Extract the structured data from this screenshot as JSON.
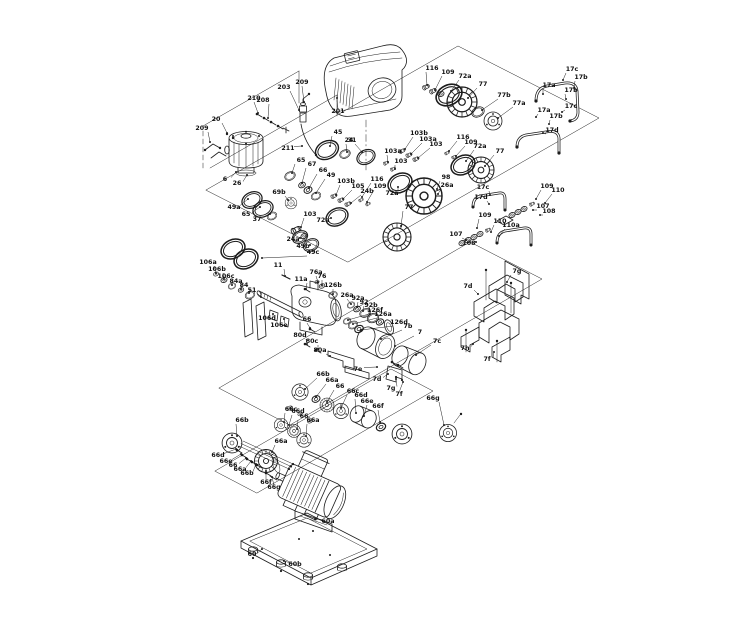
{
  "colors": {
    "background": "#ffffff",
    "line": "#1c1c1c",
    "label": "#111111"
  },
  "labels": [
    {
      "t": "208",
      "x": 263,
      "y": 102,
      "ex": 268,
      "ey": 118
    },
    {
      "t": "203",
      "x": 284,
      "y": 89,
      "ex": 299,
      "ey": 110
    },
    {
      "t": "209",
      "x": 302,
      "y": 84,
      "ex": 304,
      "ey": 102
    },
    {
      "t": "201",
      "x": 338,
      "y": 113,
      "ex": 337,
      "ey": 98
    },
    {
      "t": "210",
      "x": 254,
      "y": 100,
      "ex": 258,
      "ey": 113
    },
    {
      "t": "20",
      "x": 216,
      "y": 121,
      "ex": 227,
      "ey": 133
    },
    {
      "t": "209",
      "x": 202,
      "y": 130,
      "ex": 210,
      "ey": 142
    },
    {
      "t": "211",
      "x": 288,
      "y": 150,
      "ex": 302,
      "ey": 146
    },
    {
      "t": "45",
      "x": 338,
      "y": 134,
      "ex": 330,
      "ey": 146
    },
    {
      "t": "31",
      "x": 352,
      "y": 142,
      "ex": 347,
      "ey": 152
    },
    {
      "t": "65",
      "x": 301,
      "y": 162,
      "ex": 292,
      "ey": 173
    },
    {
      "t": "67",
      "x": 312,
      "y": 166,
      "ex": 302,
      "ey": 183
    },
    {
      "t": "66",
      "x": 323,
      "y": 172,
      "ex": 309,
      "ey": 188
    },
    {
      "t": "49",
      "x": 331,
      "y": 177,
      "ex": 316,
      "ey": 193
    },
    {
      "t": "6",
      "x": 225,
      "y": 181,
      "ex": 236,
      "ey": 172
    },
    {
      "t": "26",
      "x": 237,
      "y": 185,
      "ex": 247,
      "ey": 175
    },
    {
      "t": "49a",
      "x": 234,
      "y": 209,
      "ex": 248,
      "ey": 199
    },
    {
      "t": "65",
      "x": 246,
      "y": 216,
      "ex": 260,
      "ey": 207
    },
    {
      "t": "37",
      "x": 257,
      "y": 221,
      "ex": 270,
      "ey": 214
    },
    {
      "t": "69b",
      "x": 279,
      "y": 194,
      "ex": 288,
      "ey": 200
    },
    {
      "t": "116",
      "x": 432,
      "y": 70,
      "ex": 427,
      "ey": 85
    },
    {
      "t": "109",
      "x": 448,
      "y": 74,
      "ex": 435,
      "ey": 90
    },
    {
      "t": "72a",
      "x": 465,
      "y": 78,
      "ex": 451,
      "ey": 91
    },
    {
      "t": "77",
      "x": 483,
      "y": 86,
      "ex": 468,
      "ey": 98
    },
    {
      "t": "77b",
      "x": 504,
      "y": 97,
      "ex": 482,
      "ey": 110
    },
    {
      "t": "77a",
      "x": 519,
      "y": 105,
      "ex": 498,
      "ey": 118
    },
    {
      "t": "17c",
      "x": 572,
      "y": 71,
      "ex": 563,
      "ey": 80
    },
    {
      "t": "17b",
      "x": 581,
      "y": 79,
      "ex": 574,
      "ey": 88
    },
    {
      "t": "17a",
      "x": 549,
      "y": 87,
      "ex": 543,
      "ey": 94
    },
    {
      "t": "17b",
      "x": 571,
      "y": 92,
      "ex": 566,
      "ey": 99
    },
    {
      "t": "17c",
      "x": 571,
      "y": 108,
      "ex": 562,
      "ey": 112
    },
    {
      "t": "17a",
      "x": 544,
      "y": 112,
      "ex": 536,
      "ey": 117
    },
    {
      "t": "17b",
      "x": 556,
      "y": 118,
      "ex": 549,
      "ey": 124
    },
    {
      "t": "17d",
      "x": 552,
      "y": 132,
      "ex": 543,
      "ey": 133
    },
    {
      "t": "103b",
      "x": 419,
      "y": 135,
      "ex": 405,
      "ey": 149
    },
    {
      "t": "103a",
      "x": 428,
      "y": 141,
      "ex": 411,
      "ey": 154
    },
    {
      "t": "103",
      "x": 436,
      "y": 146,
      "ex": 418,
      "ey": 158
    },
    {
      "t": "116",
      "x": 463,
      "y": 139,
      "ex": 449,
      "ey": 151
    },
    {
      "t": "109",
      "x": 471,
      "y": 144,
      "ex": 456,
      "ey": 156
    },
    {
      "t": "72a",
      "x": 480,
      "y": 148,
      "ex": 466,
      "ey": 161
    },
    {
      "t": "77",
      "x": 500,
      "y": 153,
      "ex": 485,
      "ey": 166
    },
    {
      "t": "103a",
      "x": 393,
      "y": 153,
      "ex": 388,
      "ey": 162
    },
    {
      "t": "103",
      "x": 401,
      "y": 163,
      "ex": 395,
      "ey": 169
    },
    {
      "t": "24",
      "x": 349,
      "y": 142,
      "ex": 362,
      "ey": 152
    },
    {
      "t": "103b",
      "x": 346,
      "y": 183,
      "ex": 336,
      "ey": 195
    },
    {
      "t": "105",
      "x": 358,
      "y": 188,
      "ex": 343,
      "ey": 199
    },
    {
      "t": "24b",
      "x": 367,
      "y": 193,
      "ex": 351,
      "ey": 203
    },
    {
      "t": "116",
      "x": 377,
      "y": 181,
      "ex": 362,
      "ey": 197
    },
    {
      "t": "109",
      "x": 380,
      "y": 188,
      "ex": 367,
      "ey": 202
    },
    {
      "t": "72a",
      "x": 392,
      "y": 195,
      "ex": 398,
      "ey": 187
    },
    {
      "t": "98",
      "x": 446,
      "y": 179,
      "ex": 437,
      "ey": 189
    },
    {
      "t": "26a",
      "x": 447,
      "y": 187,
      "ex": 438,
      "ey": 194
    },
    {
      "t": "77",
      "x": 409,
      "y": 209,
      "ex": 401,
      "ey": 226
    },
    {
      "t": "103",
      "x": 310,
      "y": 216,
      "ex": 301,
      "ey": 227
    },
    {
      "t": "72a",
      "x": 323,
      "y": 222,
      "ex": 331,
      "ey": 218
    },
    {
      "t": "24a",
      "x": 293,
      "y": 241,
      "ex": 300,
      "ey": 238
    },
    {
      "t": "49b",
      "x": 303,
      "y": 248,
      "ex": 310,
      "ey": 245
    },
    {
      "t": "49c",
      "x": 313,
      "y": 254,
      "ex": 262,
      "ey": 258
    },
    {
      "t": "17c",
      "x": 483,
      "y": 189,
      "ex": 490,
      "ey": 195
    },
    {
      "t": "17d",
      "x": 481,
      "y": 199,
      "ex": 489,
      "ey": 204
    },
    {
      "t": "109",
      "x": 547,
      "y": 188,
      "ex": 536,
      "ey": 199
    },
    {
      "t": "110",
      "x": 558,
      "y": 192,
      "ex": 545,
      "ey": 203
    },
    {
      "t": "107",
      "x": 543,
      "y": 208,
      "ex": 533,
      "ey": 210
    },
    {
      "t": "108",
      "x": 549,
      "y": 213,
      "ex": 540,
      "ey": 215
    },
    {
      "t": "109",
      "x": 485,
      "y": 217,
      "ex": 477,
      "ey": 228
    },
    {
      "t": "110",
      "x": 500,
      "y": 223,
      "ex": 491,
      "ey": 232
    },
    {
      "t": "110a",
      "x": 511,
      "y": 227,
      "ex": 499,
      "ey": 236
    },
    {
      "t": "107",
      "x": 456,
      "y": 236,
      "ex": 466,
      "ey": 240
    },
    {
      "t": "108",
      "x": 469,
      "y": 245,
      "ex": 476,
      "ey": 242
    },
    {
      "t": "7g",
      "x": 517,
      "y": 273,
      "ex": 507,
      "ey": 282
    },
    {
      "t": "7d",
      "x": 468,
      "y": 288,
      "ex": 478,
      "ey": 294
    },
    {
      "t": "7h",
      "x": 465,
      "y": 350,
      "ex": 473,
      "ey": 344
    },
    {
      "t": "7f",
      "x": 487,
      "y": 361,
      "ex": 494,
      "ey": 352
    },
    {
      "t": "126f",
      "x": 375,
      "y": 312,
      "ex": 348,
      "ey": 320
    },
    {
      "t": "126a",
      "x": 383,
      "y": 316,
      "ex": 353,
      "ey": 324
    },
    {
      "t": "126d",
      "x": 399,
      "y": 324,
      "ex": 361,
      "ey": 330
    },
    {
      "t": "7b",
      "x": 408,
      "y": 328,
      "ex": 381,
      "ey": 339
    },
    {
      "t": "7",
      "x": 420,
      "y": 334,
      "ex": 395,
      "ey": 346
    },
    {
      "t": "7c",
      "x": 437,
      "y": 343,
      "ex": 416,
      "ey": 355
    },
    {
      "t": "7e",
      "x": 358,
      "y": 371,
      "ex": 377,
      "ey": 367
    },
    {
      "t": "7d",
      "x": 377,
      "y": 381,
      "ex": 388,
      "ey": 374
    },
    {
      "t": "7g",
      "x": 391,
      "y": 390,
      "ex": 396,
      "ey": 379
    },
    {
      "t": "7f",
      "x": 399,
      "y": 396,
      "ex": 403,
      "ey": 382
    },
    {
      "t": "106a",
      "x": 208,
      "y": 264,
      "ex": 216,
      "ey": 273
    },
    {
      "t": "106b",
      "x": 217,
      "y": 271,
      "ex": 224,
      "ey": 279
    },
    {
      "t": "106c",
      "x": 226,
      "y": 278,
      "ex": 232,
      "ey": 285
    },
    {
      "t": "84a",
      "x": 236,
      "y": 283,
      "ex": 241,
      "ey": 289
    },
    {
      "t": "84",
      "x": 244,
      "y": 287,
      "ex": 249,
      "ey": 293
    },
    {
      "t": "51",
      "x": 252,
      "y": 292,
      "ex": 261,
      "ey": 297
    },
    {
      "t": "11",
      "x": 278,
      "y": 267,
      "ex": 285,
      "ey": 276
    },
    {
      "t": "11a",
      "x": 301,
      "y": 281,
      "ex": 306,
      "ey": 289
    },
    {
      "t": "76a",
      "x": 316,
      "y": 274,
      "ex": 318,
      "ey": 282
    },
    {
      "t": "76",
      "x": 322,
      "y": 278,
      "ex": 322,
      "ey": 285
    },
    {
      "t": "126b",
      "x": 333,
      "y": 287,
      "ex": 333,
      "ey": 294
    },
    {
      "t": "26a",
      "x": 347,
      "y": 297,
      "ex": 351,
      "ey": 304
    },
    {
      "t": "92a",
      "x": 358,
      "y": 300,
      "ex": 357,
      "ey": 307
    },
    {
      "t": "92",
      "x": 364,
      "y": 304,
      "ex": 363,
      "ey": 311
    },
    {
      "t": "92b",
      "x": 371,
      "y": 307,
      "ex": 370,
      "ey": 314
    },
    {
      "t": "106d",
      "x": 267,
      "y": 320,
      "ex": 273,
      "ey": 314
    },
    {
      "t": "106e",
      "x": 279,
      "y": 327,
      "ex": 284,
      "ey": 319
    },
    {
      "t": "66",
      "x": 307,
      "y": 321,
      "ex": 310,
      "ey": 328
    },
    {
      "t": "80d",
      "x": 300,
      "y": 337,
      "ex": 307,
      "ey": 344
    },
    {
      "t": "80c",
      "x": 312,
      "y": 343,
      "ex": 318,
      "ey": 349
    },
    {
      "t": "80a",
      "x": 320,
      "y": 352,
      "ex": 330,
      "ey": 356
    },
    {
      "t": "66b",
      "x": 323,
      "y": 376,
      "ex": 305,
      "ey": 389
    },
    {
      "t": "66a",
      "x": 332,
      "y": 382,
      "ex": 316,
      "ey": 397
    },
    {
      "t": "66",
      "x": 340,
      "y": 388,
      "ex": 327,
      "ey": 402
    },
    {
      "t": "66c",
      "x": 353,
      "y": 393,
      "ex": 341,
      "ey": 408
    },
    {
      "t": "66d",
      "x": 361,
      "y": 397,
      "ex": 356,
      "ey": 413
    },
    {
      "t": "66e",
      "x": 367,
      "y": 403,
      "ex": 364,
      "ey": 416
    },
    {
      "t": "66f",
      "x": 378,
      "y": 408,
      "ex": 380,
      "ey": 422
    },
    {
      "t": "66g",
      "x": 433,
      "y": 400,
      "ex": 444,
      "ey": 425
    },
    {
      "t": "66b",
      "x": 242,
      "y": 422,
      "ex": 237,
      "ey": 436
    },
    {
      "t": "66c",
      "x": 291,
      "y": 411,
      "ex": 284,
      "ey": 422
    },
    {
      "t": "66d",
      "x": 298,
      "y": 413,
      "ex": 289,
      "ey": 425
    },
    {
      "t": "66",
      "x": 304,
      "y": 418,
      "ex": 297,
      "ey": 429
    },
    {
      "t": "66a",
      "x": 313,
      "y": 422,
      "ex": 306,
      "ey": 436
    },
    {
      "t": "66a",
      "x": 281,
      "y": 443,
      "ex": 272,
      "ey": 452
    },
    {
      "t": "66d",
      "x": 218,
      "y": 457,
      "ex": 236,
      "ey": 449
    },
    {
      "t": "66e",
      "x": 226,
      "y": 463,
      "ex": 241,
      "ey": 454
    },
    {
      "t": "66",
      "x": 233,
      "y": 467,
      "ex": 246,
      "ey": 458
    },
    {
      "t": "66a",
      "x": 240,
      "y": 471,
      "ex": 251,
      "ey": 461
    },
    {
      "t": "66b",
      "x": 247,
      "y": 475,
      "ex": 256,
      "ey": 464
    },
    {
      "t": "66f",
      "x": 266,
      "y": 484,
      "ex": 266,
      "ey": 471
    },
    {
      "t": "66g",
      "x": 274,
      "y": 489,
      "ex": 272,
      "ey": 477
    },
    {
      "t": "60a",
      "x": 328,
      "y": 523,
      "ex": 315,
      "ey": 519
    },
    {
      "t": "60",
      "x": 252,
      "y": 556,
      "ex": 262,
      "ey": 549
    },
    {
      "t": "60b",
      "x": 295,
      "y": 566,
      "ex": 284,
      "ey": 561
    }
  ]
}
